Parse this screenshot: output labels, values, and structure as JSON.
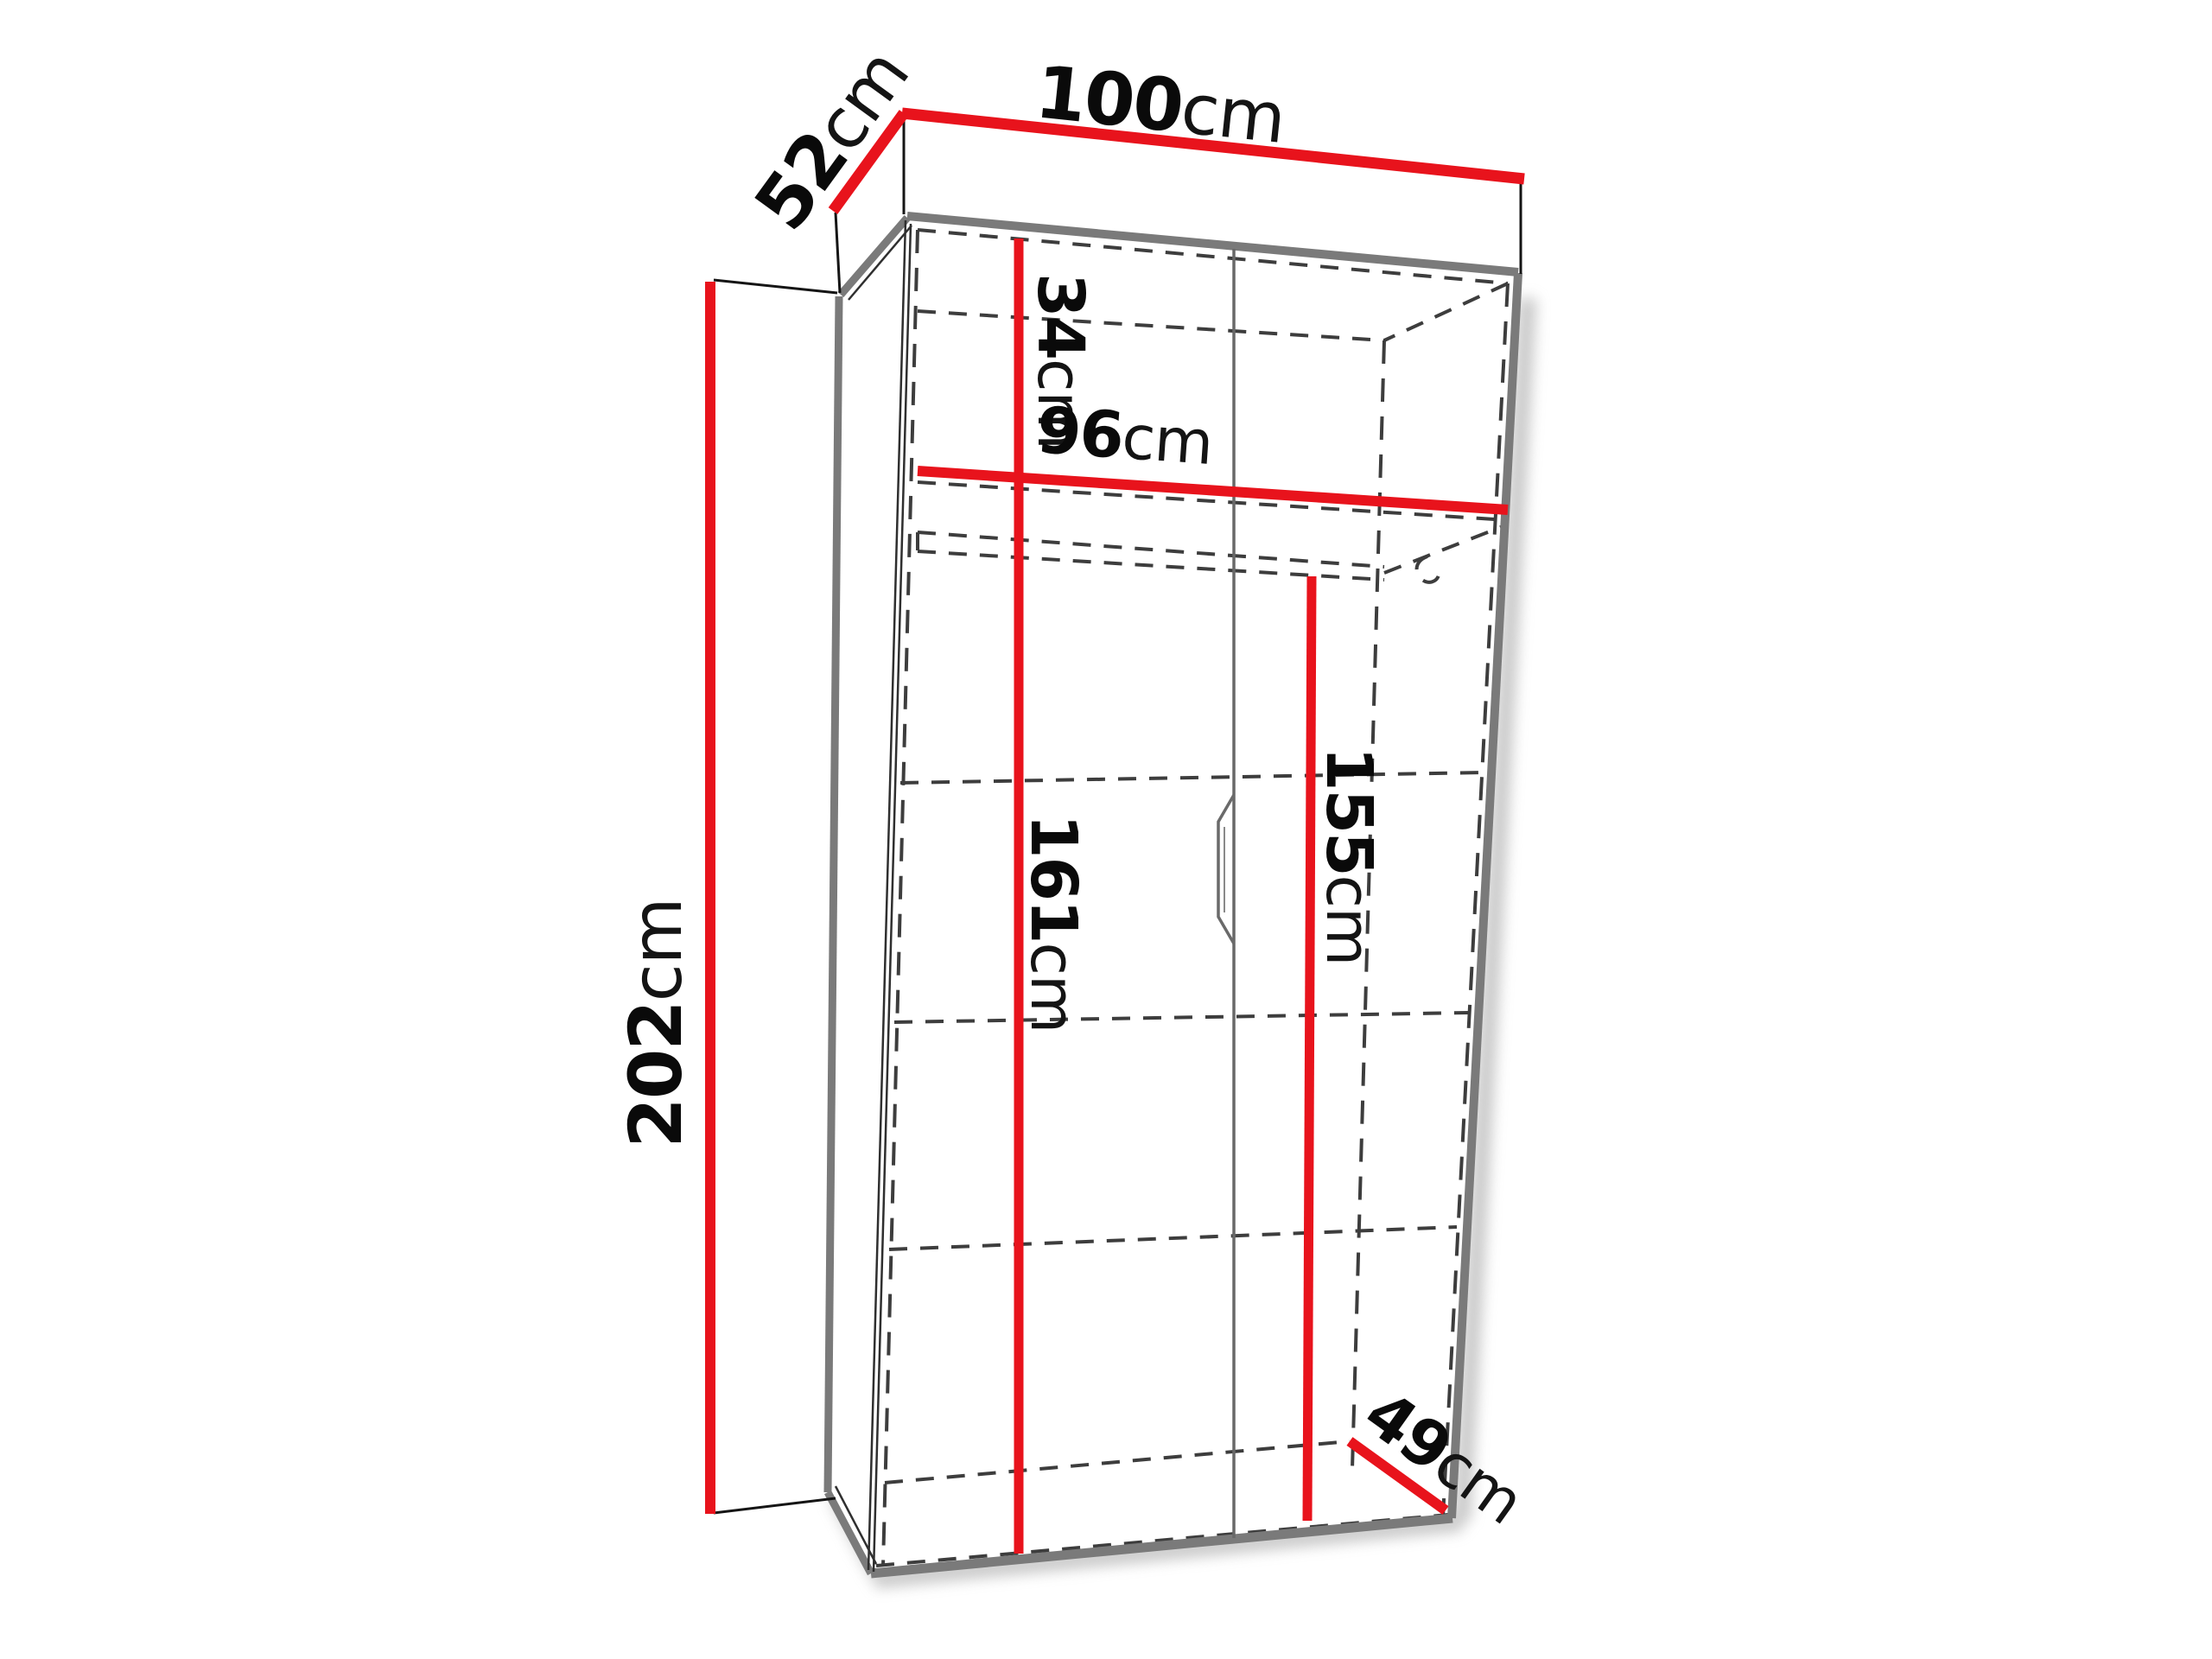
{
  "diagram": {
    "subject": "two-door wardrobe dimension drawing with top shelf and hanging rail",
    "colors": {
      "dimension_line": "#e8131c",
      "cabinet_edge": "#7a7a7a",
      "hidden_line": "#3d3d3d",
      "label_text": "#0a0a0a",
      "background": "#ffffff"
    }
  },
  "dims": {
    "top_width": {
      "num": "100",
      "unit": "cm"
    },
    "top_depth": {
      "num": "52",
      "unit": "cm"
    },
    "height": {
      "num": "202",
      "unit": "cm"
    },
    "top_compartment": {
      "num": "34",
      "unit": "cm"
    },
    "interior_width": {
      "num": "96",
      "unit": "cm"
    },
    "left_interior_h": {
      "num": "161",
      "unit": "cm"
    },
    "hanging_height": {
      "num": "155",
      "unit": "cm"
    },
    "bottom_depth": {
      "num": "49",
      "unit": "cm"
    }
  }
}
